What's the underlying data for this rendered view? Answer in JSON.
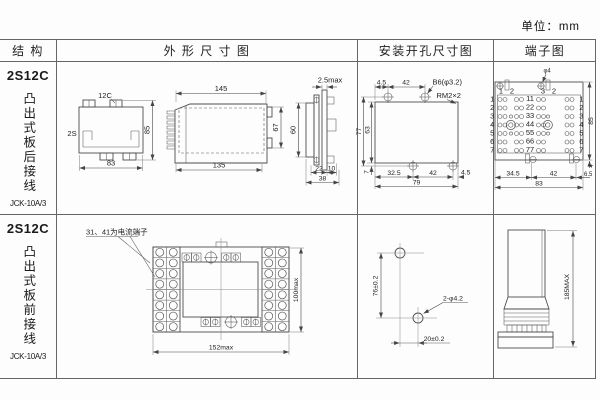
{
  "unit_label": "单位：mm",
  "headers": {
    "structure": "结 构",
    "outline": "外 形 尺 寸 图",
    "mounting": "安装开孔尺寸图",
    "terminal": "端子图"
  },
  "rows": [
    {
      "model": "2S12C",
      "mount_type": "凸出式板后接线",
      "product": "JCK-10A/3"
    },
    {
      "model": "2S12C",
      "mount_type": "凸出式板前接线",
      "product": "JCK-10A/3"
    }
  ],
  "r1": {
    "back": {
      "top_label": "12C",
      "side_label": "2S",
      "width": "83",
      "height": "85"
    },
    "side": {
      "top": "145",
      "bottom": "135",
      "height": "67"
    },
    "panel": {
      "thickness": "2.5max",
      "height": "60",
      "b1": "22",
      "b2": "10",
      "b3": "38"
    },
    "mount": {
      "t1": "4.5",
      "t2": "42",
      "hole": "B6(φ3.2)",
      "thread": "RM2×2",
      "l1": "77",
      "l2": "63",
      "b0": "7",
      "b1": "32.5",
      "b2": "42",
      "b3": "4.5",
      "b4": "79"
    },
    "term": {
      "hole": "φ4",
      "height": "85",
      "notch": "4",
      "b1": "34.5",
      "b2": "42",
      "b3": "6.5",
      "b4": "83",
      "rows": [
        "1",
        "2",
        "3",
        "4",
        "5",
        "6",
        "7"
      ],
      "pairs": [
        "11",
        "22",
        "33",
        "44",
        "55",
        "66",
        "77"
      ],
      "top_labels": [
        "1",
        "2",
        "3",
        "2"
      ]
    }
  },
  "r2": {
    "note": "31、41为电流端子",
    "front": {
      "width": "152max",
      "height": "100max"
    },
    "mount": {
      "v": "76±0.2",
      "h": "20±0.2",
      "hole": "2-φ4.2"
    },
    "side": {
      "height": "185MAX"
    }
  }
}
